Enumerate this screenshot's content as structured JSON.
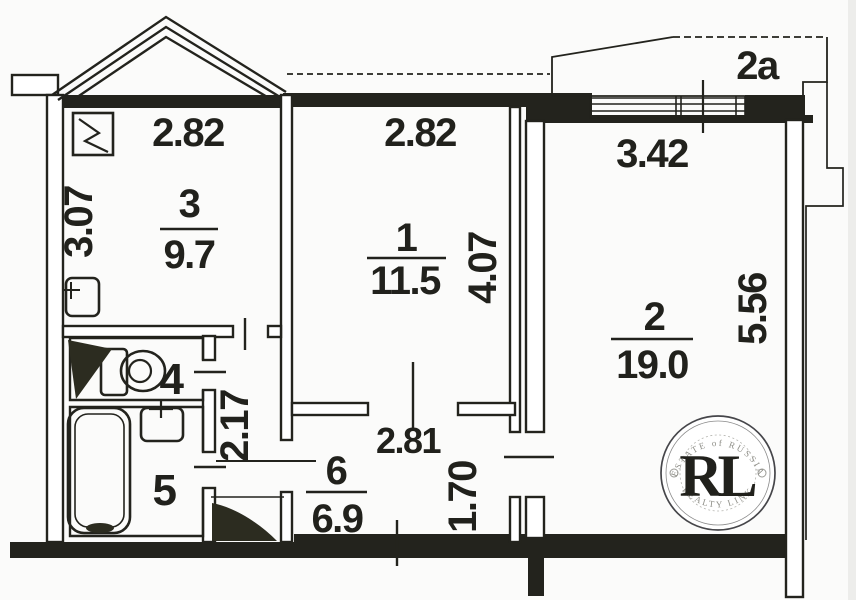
{
  "plan": {
    "kitchen": {
      "number": "3",
      "area": "9.7",
      "width": "2.82",
      "depth": "3.07"
    },
    "room1": {
      "number": "1",
      "area": "11.5",
      "width": "2.82",
      "depth": "4.07"
    },
    "room2": {
      "number": "2",
      "area": "19.0",
      "width": "3.42",
      "depth": "5.56"
    },
    "hall": {
      "number": "6",
      "area": "6.9",
      "width": "2.81",
      "depth": "1.70"
    },
    "toilet": {
      "number": "4"
    },
    "bathroom": {
      "number": "5"
    },
    "corridor": {
      "depth": "2.17"
    },
    "balcony": {
      "label": "2a"
    }
  },
  "watermark": {
    "arc_top": "ESTATE of RUSSIA",
    "initials": "RL",
    "arc_bottom": "REALTY LINK"
  },
  "colors": {
    "ink": "#23231d",
    "gold_dark": "#b8860b",
    "gold_light": "#d9b35c"
  }
}
